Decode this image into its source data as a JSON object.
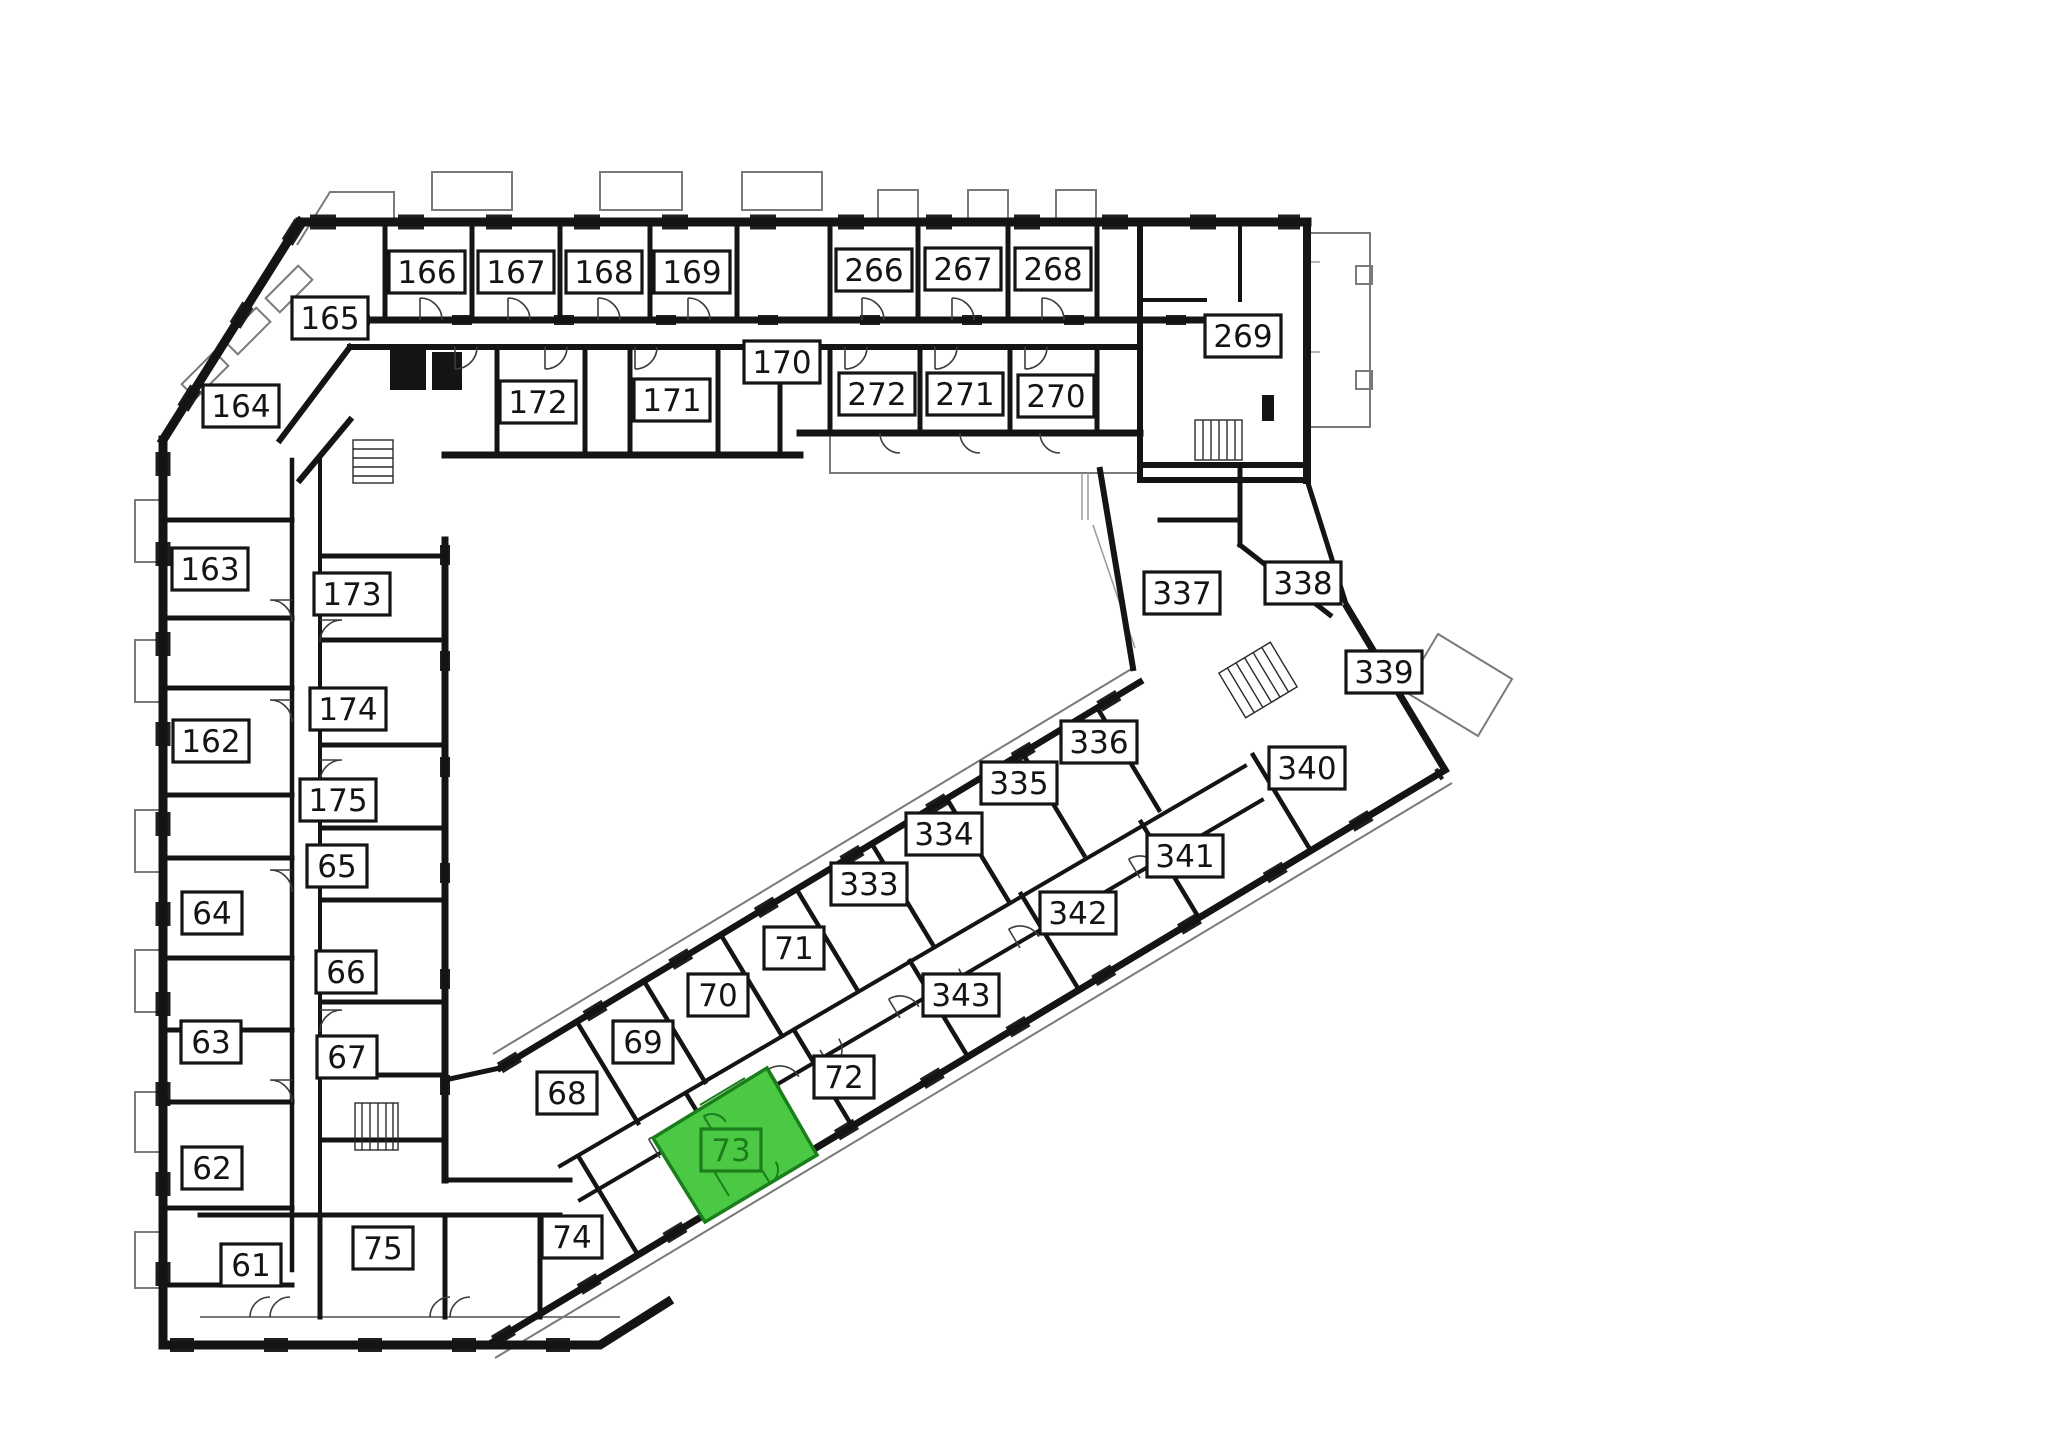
{
  "plan": {
    "type": "building-floor-plan",
    "highlighted_room": "73",
    "colors": {
      "wall": "#141414",
      "label_bg": "#ffffff",
      "label_border": "#141414",
      "label_text": "#141414",
      "highlight_fill": "#4cc944",
      "highlight_dark": "#1b7e1b"
    },
    "rooms": [
      {
        "number": "166",
        "x": 427,
        "y": 272
      },
      {
        "number": "167",
        "x": 516,
        "y": 272
      },
      {
        "number": "168",
        "x": 604,
        "y": 272
      },
      {
        "number": "169",
        "x": 692,
        "y": 272
      },
      {
        "number": "266",
        "x": 874,
        "y": 270
      },
      {
        "number": "267",
        "x": 963,
        "y": 269
      },
      {
        "number": "268",
        "x": 1053,
        "y": 269
      },
      {
        "number": "269",
        "x": 1243,
        "y": 336
      },
      {
        "number": "165",
        "x": 330,
        "y": 318
      },
      {
        "number": "164",
        "x": 241,
        "y": 406
      },
      {
        "number": "172",
        "x": 538,
        "y": 402
      },
      {
        "number": "171",
        "x": 672,
        "y": 400
      },
      {
        "number": "170",
        "x": 782,
        "y": 362
      },
      {
        "number": "272",
        "x": 877,
        "y": 394
      },
      {
        "number": "271",
        "x": 965,
        "y": 394
      },
      {
        "number": "270",
        "x": 1056,
        "y": 396
      },
      {
        "number": "163",
        "x": 210,
        "y": 569
      },
      {
        "number": "173",
        "x": 352,
        "y": 594
      },
      {
        "number": "174",
        "x": 348,
        "y": 709
      },
      {
        "number": "162",
        "x": 211,
        "y": 741
      },
      {
        "number": "175",
        "x": 338,
        "y": 800
      },
      {
        "number": "65",
        "x": 337,
        "y": 866
      },
      {
        "number": "64",
        "x": 212,
        "y": 913
      },
      {
        "number": "66",
        "x": 346,
        "y": 972
      },
      {
        "number": "63",
        "x": 211,
        "y": 1042
      },
      {
        "number": "67",
        "x": 347,
        "y": 1057
      },
      {
        "number": "62",
        "x": 212,
        "y": 1168
      },
      {
        "number": "61",
        "x": 251,
        "y": 1265
      },
      {
        "number": "75",
        "x": 383,
        "y": 1248
      },
      {
        "number": "337",
        "x": 1182,
        "y": 593
      },
      {
        "number": "338",
        "x": 1303,
        "y": 583
      },
      {
        "number": "339",
        "x": 1384,
        "y": 672
      },
      {
        "number": "336",
        "x": 1099,
        "y": 742
      },
      {
        "number": "340",
        "x": 1307,
        "y": 768
      },
      {
        "number": "335",
        "x": 1019,
        "y": 783
      },
      {
        "number": "334",
        "x": 944,
        "y": 834
      },
      {
        "number": "341",
        "x": 1185,
        "y": 856
      },
      {
        "number": "333",
        "x": 869,
        "y": 884
      },
      {
        "number": "342",
        "x": 1078,
        "y": 913
      },
      {
        "number": "71",
        "x": 794,
        "y": 948
      },
      {
        "number": "343",
        "x": 961,
        "y": 995
      },
      {
        "number": "70",
        "x": 718,
        "y": 995
      },
      {
        "number": "69",
        "x": 643,
        "y": 1042
      },
      {
        "number": "72",
        "x": 844,
        "y": 1077
      },
      {
        "number": "68",
        "x": 567,
        "y": 1093
      },
      {
        "number": "73",
        "x": 731,
        "y": 1150,
        "highlighted": true
      },
      {
        "number": "74",
        "x": 572,
        "y": 1237
      }
    ]
  }
}
